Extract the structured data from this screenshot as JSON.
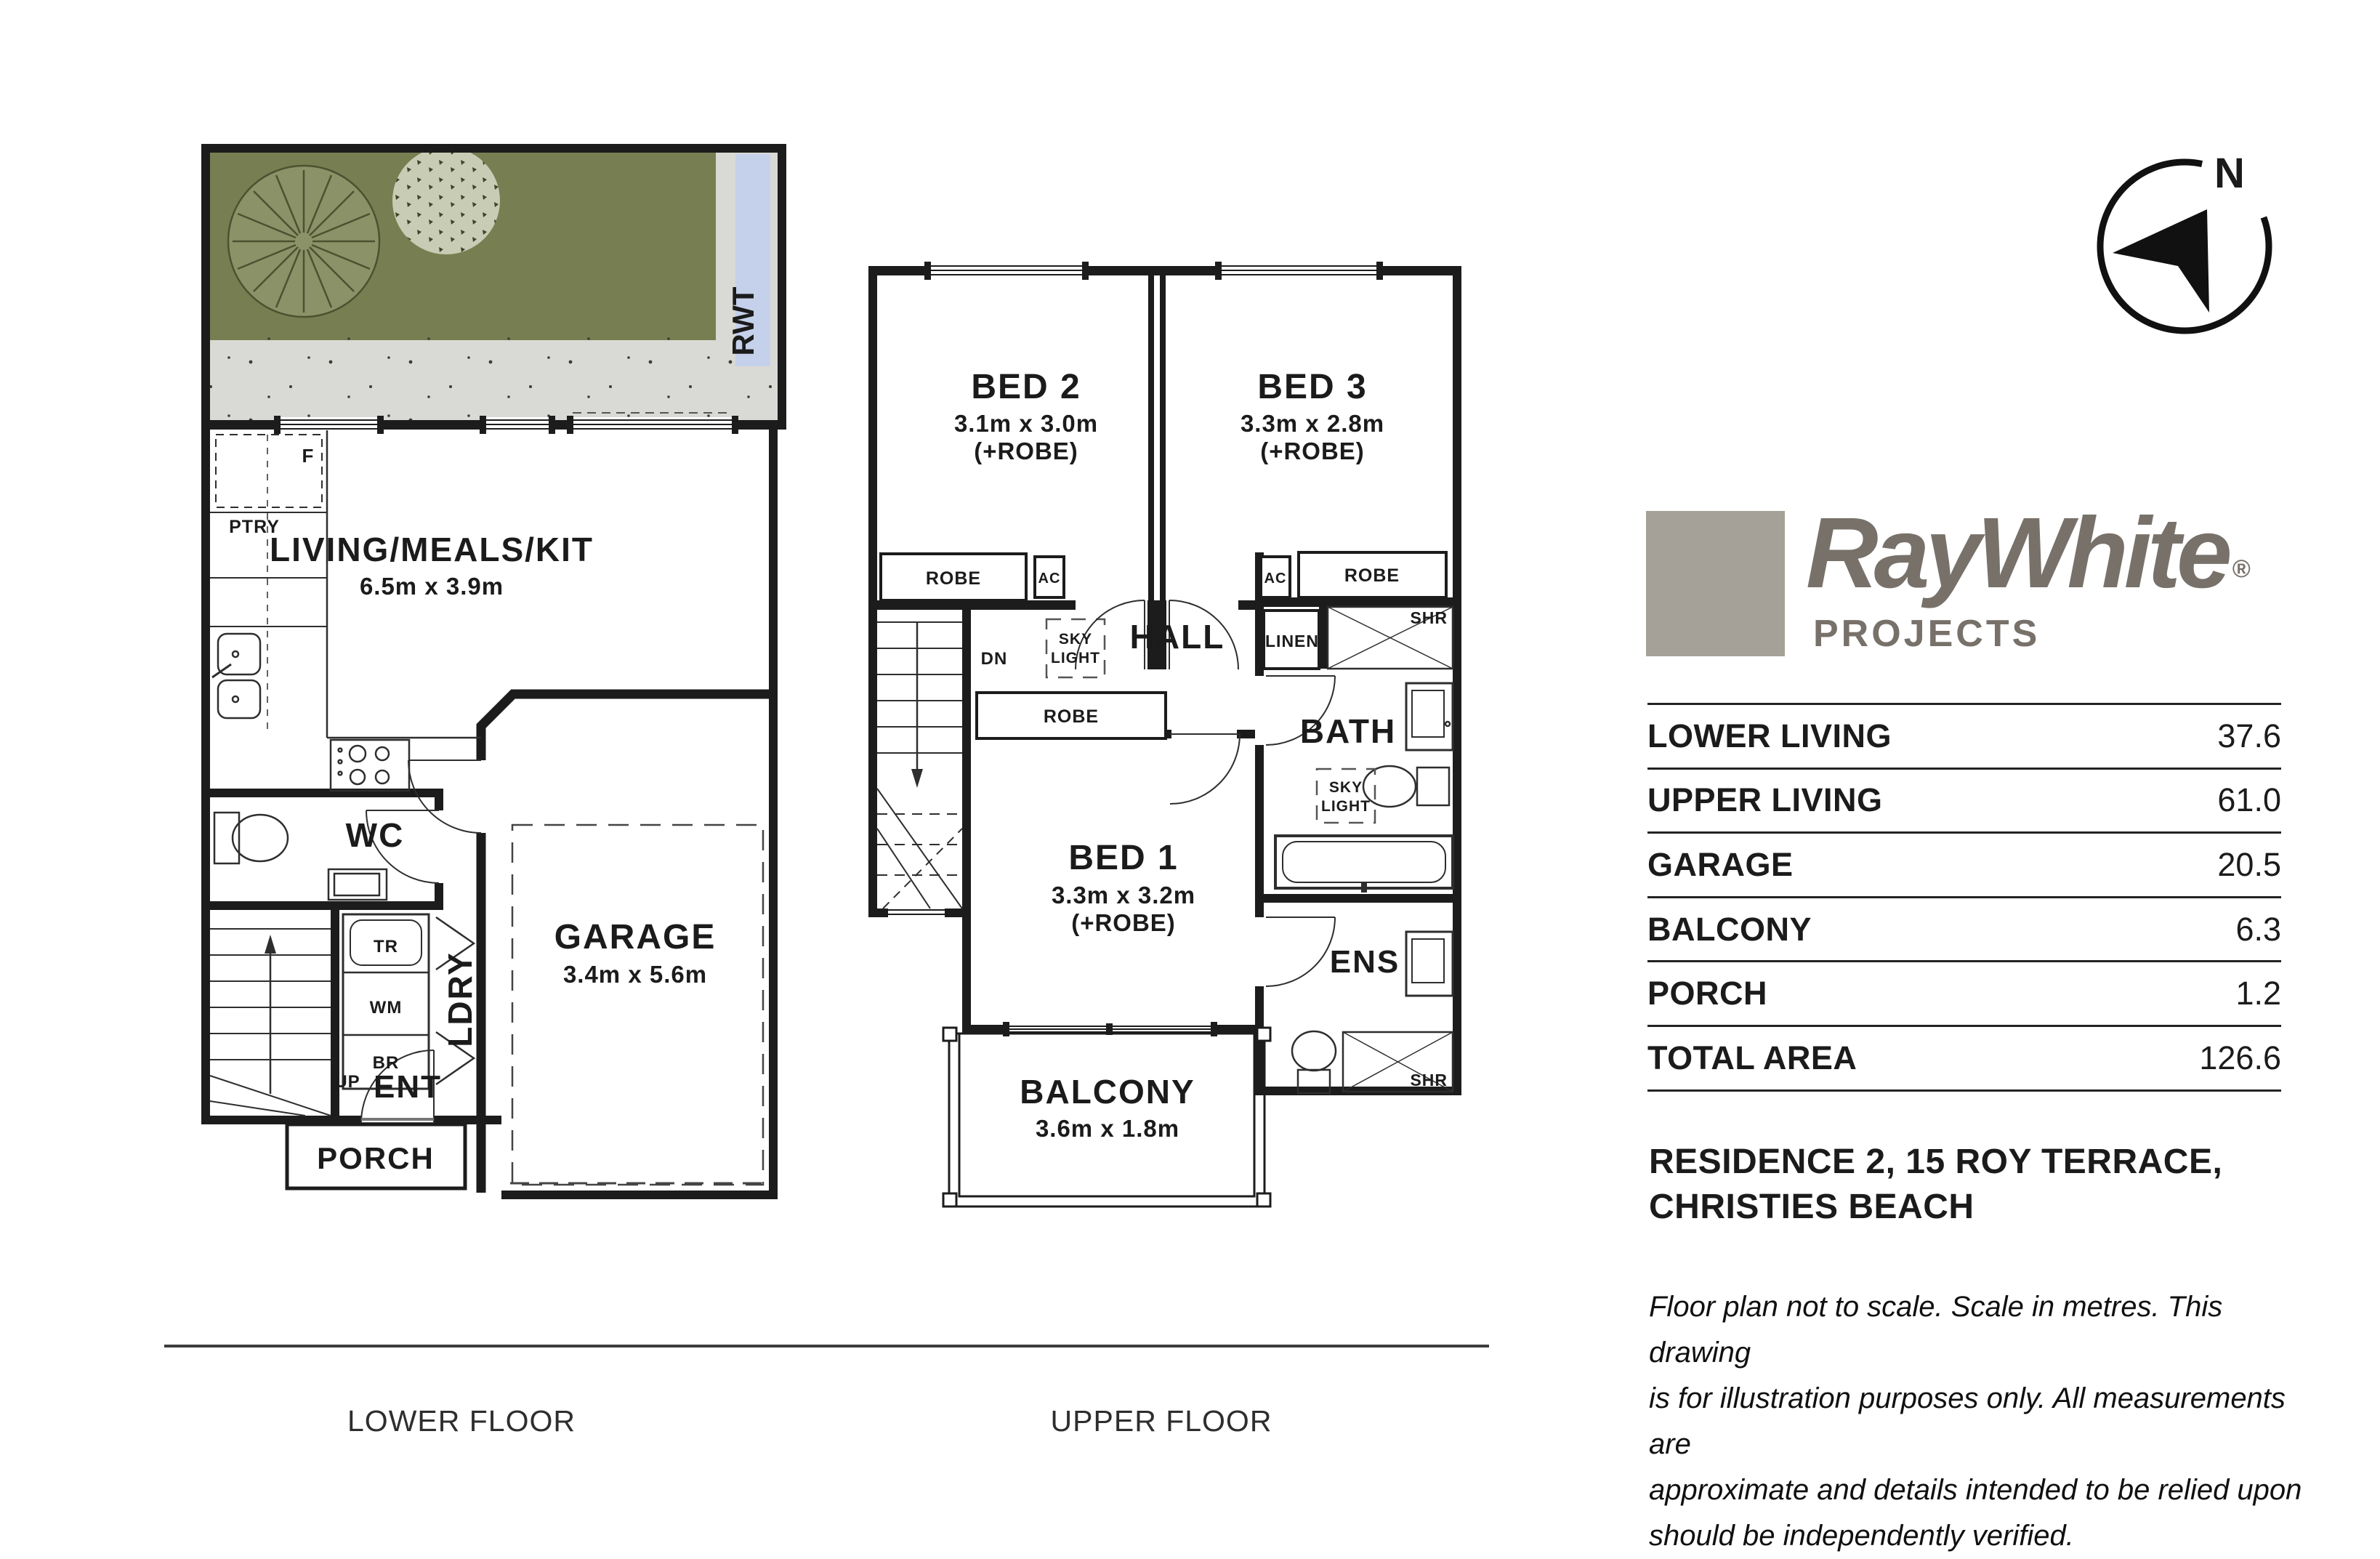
{
  "compass": {
    "n": "N"
  },
  "brand": {
    "name": "RayWhite",
    "reg": "®",
    "sub": "PROJECTS",
    "text_color": "#77716a",
    "square_color": "#a6a198"
  },
  "area_table": {
    "rows": [
      {
        "label": "LOWER LIVING",
        "value": "37.6"
      },
      {
        "label": "UPPER LIVING",
        "value": "61.0"
      },
      {
        "label": "GARAGE",
        "value": "20.5"
      },
      {
        "label": "BALCONY",
        "value": "6.3"
      },
      {
        "label": "PORCH",
        "value": "1.2"
      },
      {
        "label": "TOTAL AREA",
        "value": "126.6"
      }
    ]
  },
  "address": {
    "lines": [
      "RESIDENCE 2, 15 ROY TERRACE,",
      "CHRISTIES BEACH"
    ]
  },
  "disclaimer": {
    "lines": [
      "Floor plan not to scale. Scale in metres. This drawing",
      "is for illustration purposes only. All measurements are",
      "approximate and details intended to be relied upon",
      "should be independently verified."
    ]
  },
  "floor_labels": {
    "lower": "LOWER FLOOR",
    "upper": "UPPER FLOOR"
  },
  "lower_floor": {
    "living_name": "LIVING/MEALS/KIT",
    "living_dims": "6.5m x 3.9m",
    "garage_name": "GARAGE",
    "garage_dims": "3.4m x 5.6m",
    "wc": "WC",
    "ldry": "LDRY",
    "ent": "ENT",
    "porch": "PORCH",
    "up": "UP",
    "fridge": "F",
    "ptry": "PTRY",
    "tr": "TR",
    "wm": "WM",
    "br": "BR",
    "rwt": "RWT"
  },
  "upper_floor": {
    "bed1": {
      "name": "BED 1",
      "dims": "3.3m x 3.2m",
      "note": "(+ROBE)"
    },
    "bed2": {
      "name": "BED 2",
      "dims": "3.1m x 3.0m",
      "note": "(+ROBE)"
    },
    "bed3": {
      "name": "BED 3",
      "dims": "3.3m x 2.8m",
      "note": "(+ROBE)"
    },
    "hall": "HALL",
    "bath": "BATH",
    "ens": "ENS",
    "balcony": {
      "name": "BALCONY",
      "dims": "3.6m x 1.8m"
    },
    "robe": "ROBE",
    "ac": "AC",
    "dn": "DN",
    "linen": "LINEN",
    "shr": "SHR",
    "sky": "SKY",
    "light": "LIGHT"
  },
  "colors": {
    "garden_green": "#777e51",
    "paving_gray": "#d9d9d5",
    "rwt_blue": "#c5d1ea",
    "wall_black": "#1c1c1c"
  }
}
